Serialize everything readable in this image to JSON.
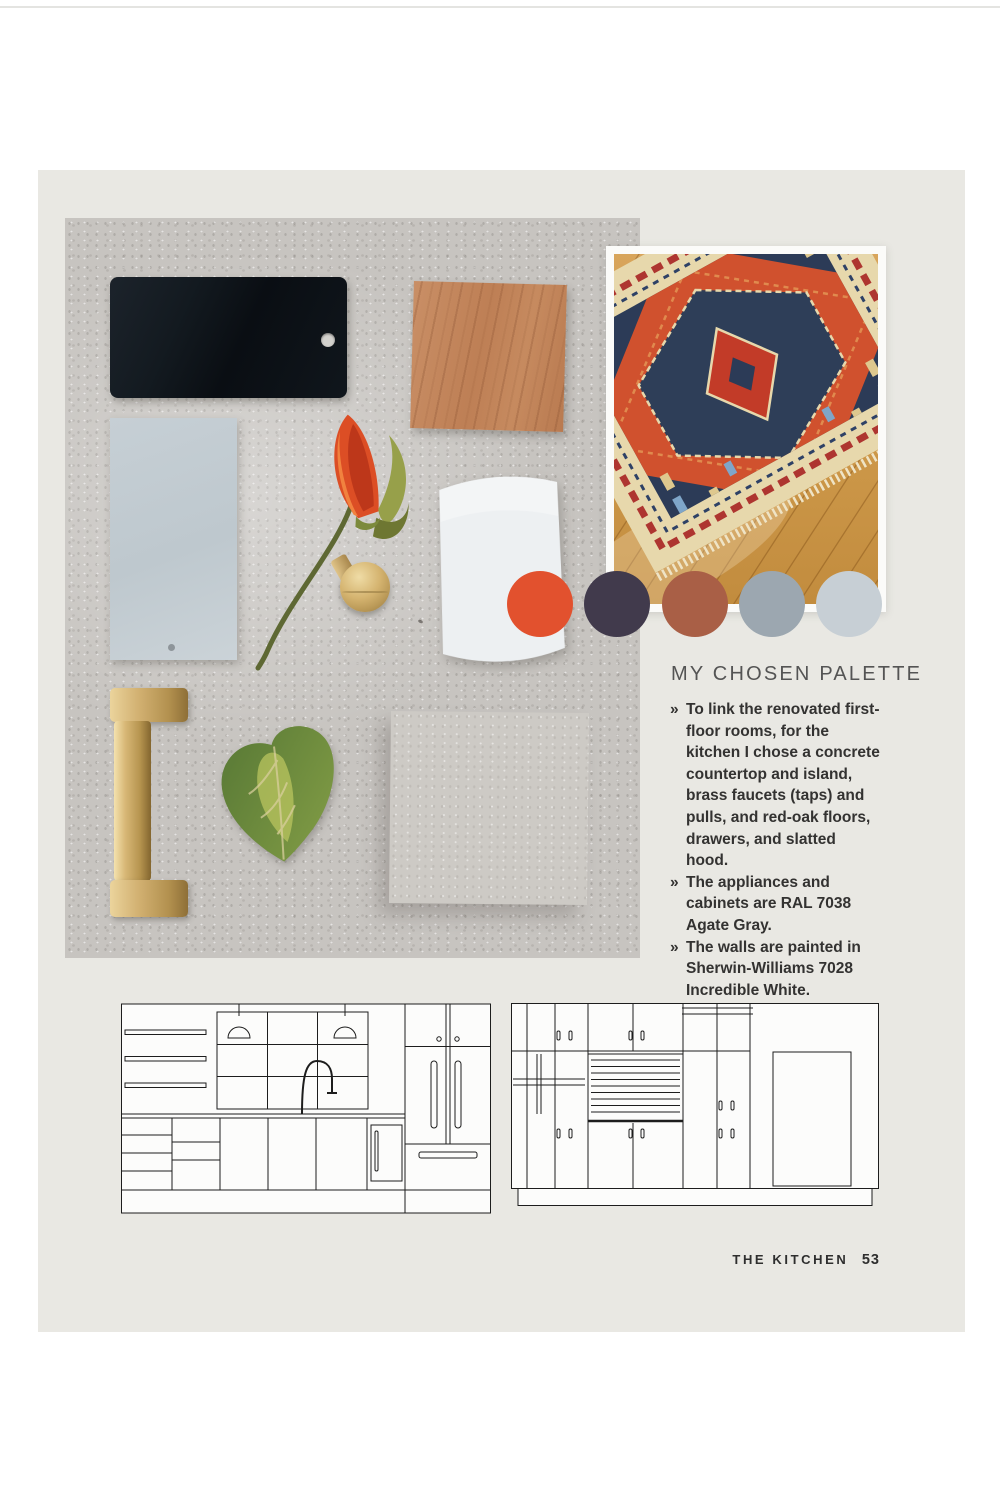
{
  "palette": {
    "heading": "MY CHOSEN PALETTE",
    "colors": [
      "#E2512E",
      "#413A4C",
      "#A95F46",
      "#9CA7B0",
      "#C7CFD5"
    ],
    "bullets": [
      {
        "marker": "»",
        "text": "To link the renovated first-floor rooms, for the kitchen I chose a concrete countertop and island, brass faucets (taps) and pulls, and red-oak floors, drawers, and slatted hood."
      },
      {
        "marker": "»",
        "text": "The appliances and cabinets are RAL 7038 Agate Gray."
      },
      {
        "marker": "»",
        "text": "The walls are painted in Sherwin-Williams 7028 Incredible White."
      }
    ]
  },
  "footer": {
    "section": "THE KITCHEN",
    "page_number": "53"
  }
}
